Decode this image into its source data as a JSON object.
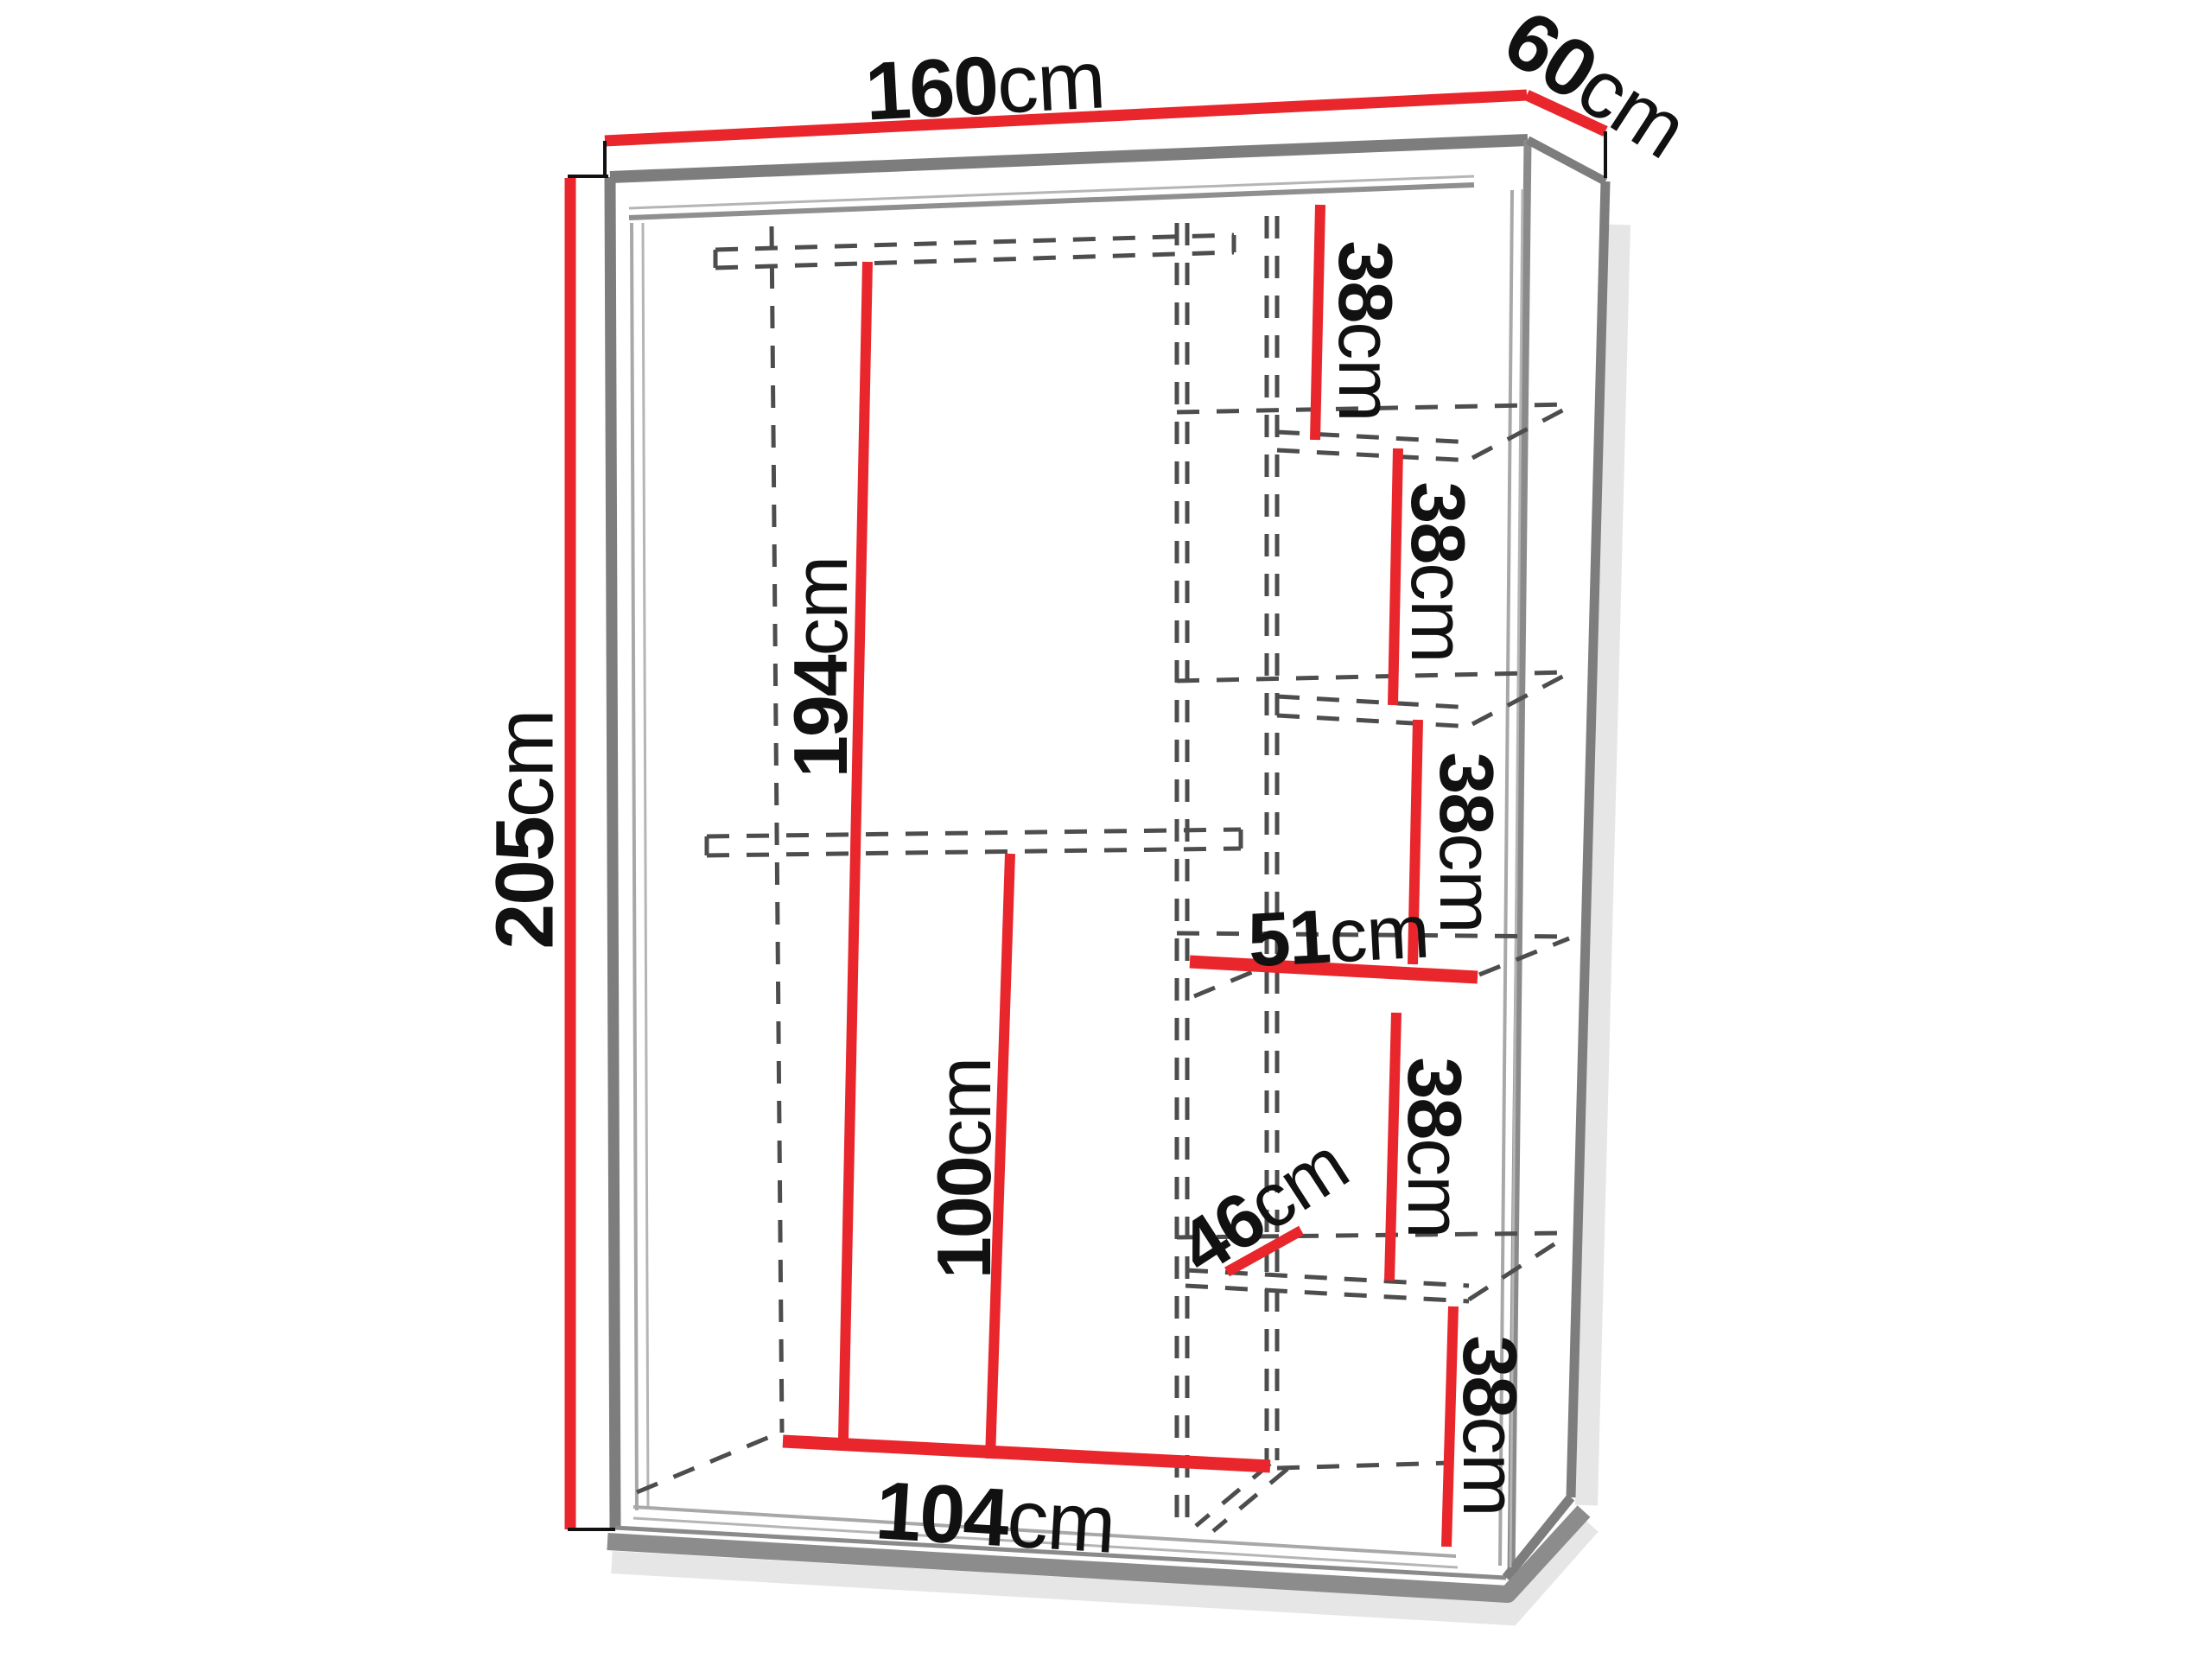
{
  "colors": {
    "dimension_red": "#e8262b",
    "frame_gray": "#7d7d7d",
    "frame_gray_light": "#a8a8a8",
    "dashed_gray": "#4d4d4d",
    "shadow_gray": "#8c8c8c",
    "label_black": "#111111",
    "background": "#ffffff"
  },
  "labels": {
    "width": {
      "value": "160",
      "unit": "cm"
    },
    "depth": {
      "value": "60",
      "unit": "cm"
    },
    "height": {
      "value": "205",
      "unit": "cm"
    },
    "left_hanging_height": {
      "value": "194",
      "unit": "cm"
    },
    "lower_hanging_height": {
      "value": "100",
      "unit": "cm"
    },
    "left_interior_width": {
      "value": "104",
      "unit": "cm"
    },
    "shelf_width": {
      "value": "51",
      "unit": "cm"
    },
    "shelf_depth": {
      "value": "46",
      "unit": "cm"
    },
    "shelf_gap_1": {
      "value": "38",
      "unit": "cm"
    },
    "shelf_gap_2": {
      "value": "38",
      "unit": "cm"
    },
    "shelf_gap_3": {
      "value": "38",
      "unit": "cm"
    },
    "shelf_gap_4": {
      "value": "38",
      "unit": "cm"
    },
    "shelf_gap_5": {
      "value": "38",
      "unit": "cm"
    }
  }
}
